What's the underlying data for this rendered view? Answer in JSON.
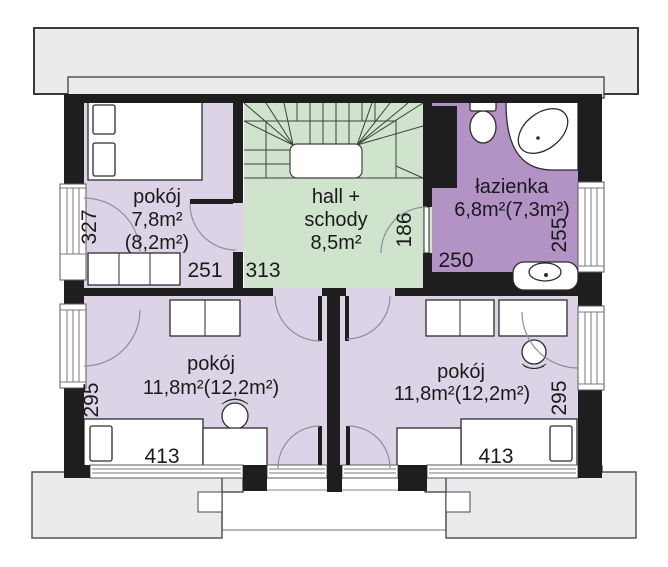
{
  "rooms": [
    {
      "name": "pokój",
      "area": "7,8m²",
      "area_alt": "(8,2m²)"
    },
    {
      "name_line1": "hall +",
      "name_line2": "schody",
      "area": "8,5m²"
    },
    {
      "name": "łazienka",
      "area": "6,8m²(7,3m²)"
    },
    {
      "name": "pokój",
      "area": "11,8m²(12,2m²)"
    },
    {
      "name": "pokój",
      "area": "11,8m²(12,2m²)"
    }
  ],
  "dimensions": {
    "small_room_window": "327",
    "small_room_width": "251",
    "hall_width": "313",
    "bath_door": "186",
    "bath_width": "250",
    "bath_window": "255",
    "left_room_window": "295",
    "right_room_window": "295",
    "left_room_bed": "413",
    "right_room_bed": "413"
  },
  "colors": {
    "wall_black": "#1e1e1e",
    "roof_gray": "#ebebee",
    "bedroom_lavender": "#dcd4e6",
    "hall_green": "#d0e3cd",
    "bathroom_purple": "#b392c6",
    "dim_text": "#1a1a1a"
  },
  "fixtures": [
    "staircase",
    "double-bed",
    "wardrobe",
    "desk",
    "chair",
    "single-bed",
    "toilet",
    "corner-bathtub",
    "washbasin",
    "balcony"
  ]
}
